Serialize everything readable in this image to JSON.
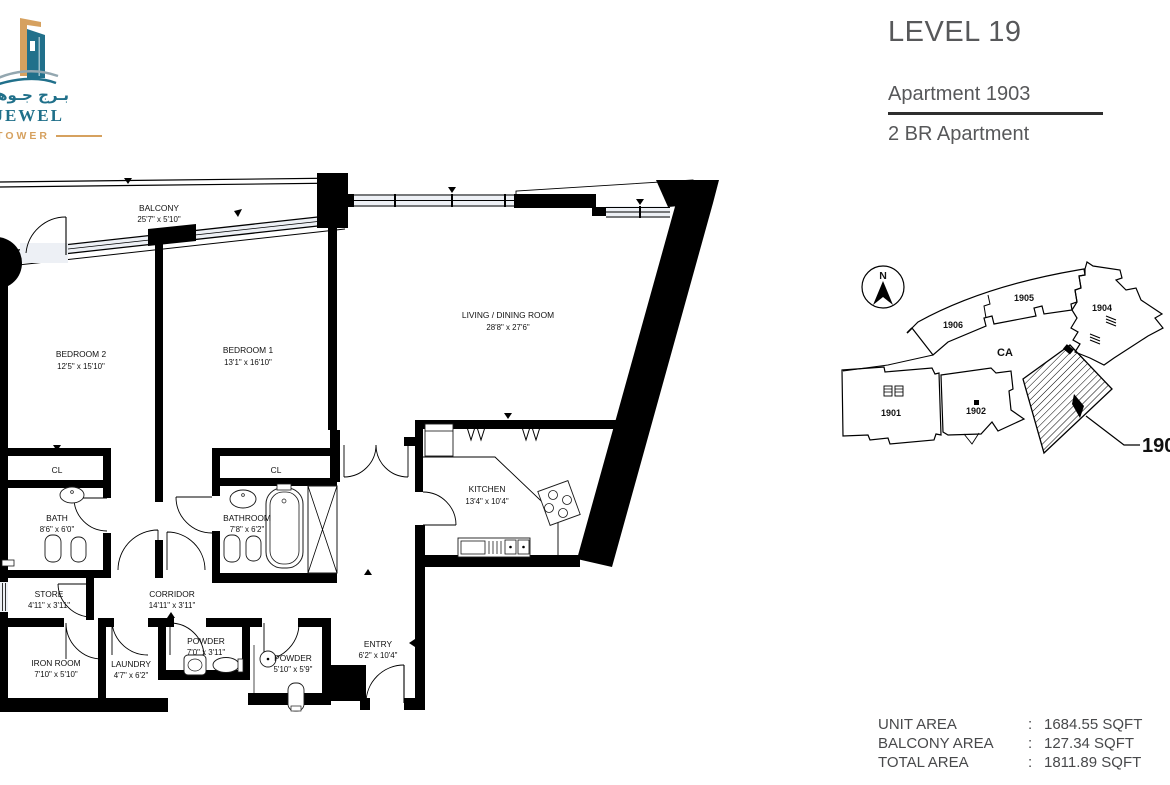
{
  "logo": {
    "arabic": "بـرج جـوهـرة",
    "brand": "H JEWEL",
    "tower": "TOWER"
  },
  "header": {
    "level": "LEVEL 19",
    "apartment": "Apartment 1903",
    "type": "2 BR Apartment"
  },
  "floorplan": {
    "rooms": [
      {
        "name": "BALCONY",
        "dim": "25'7\" x 5'10\""
      },
      {
        "name": "BEDROOM 2",
        "dim": "12'5\" x 15'10\""
      },
      {
        "name": "BEDROOM 1",
        "dim": "13'1\" x 16'10\""
      },
      {
        "name": "LIVING / DINING ROOM",
        "dim": "28'8\" x 27'6\""
      },
      {
        "name": "KITCHEN",
        "dim": "13'4\" x 10'4\""
      },
      {
        "name": "CL",
        "dim": ""
      },
      {
        "name": "CL",
        "dim": ""
      },
      {
        "name": "BATH",
        "dim": "8'6\" x 6'0\""
      },
      {
        "name": "BATHROOM",
        "dim": "7'8\" x 6'2\""
      },
      {
        "name": "STORE",
        "dim": "4'11\" x 3'11\""
      },
      {
        "name": "CORRIDOR",
        "dim": "14'11\" x 3'11\""
      },
      {
        "name": "IRON ROOM",
        "dim": "7'10\" x 5'10\""
      },
      {
        "name": "LAUNDRY",
        "dim": "4'7\" x 6'2\""
      },
      {
        "name": "POWDER",
        "dim": "7'0\" x 3'11\""
      },
      {
        "name": "POWDER",
        "dim": "5'10\" x 5'9\""
      },
      {
        "name": "ENTRY",
        "dim": "6'2\" x 10'4\""
      }
    ]
  },
  "keyplan": {
    "north": "N",
    "ca": "CA",
    "units": [
      "1906",
      "1905",
      "1904",
      "1901",
      "1902"
    ],
    "highlight": "1903"
  },
  "areas": {
    "colon": ":",
    "rows": [
      {
        "label": "UNIT AREA",
        "value": "1684.55 SQFT"
      },
      {
        "label": "BALCONY AREA",
        "value": "127.34 SQFT"
      },
      {
        "label": "TOTAL AREA",
        "value": "1811.89 SQFT"
      }
    ]
  },
  "colors": {
    "teal": "#20708a",
    "gold": "#d6a15f",
    "text_gray": "#57585a",
    "plan_black": "#000000"
  }
}
